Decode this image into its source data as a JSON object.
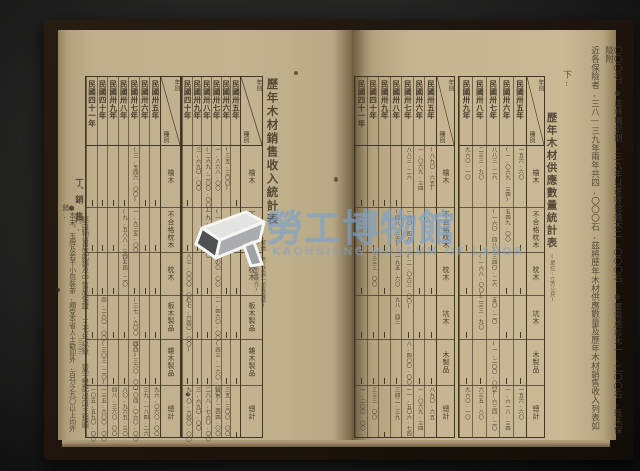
{
  "watermark": {
    "cjk": "勞工博物館",
    "latin": "KAOHSIUNG MUSEUM OF LABOR",
    "accent_color": "#7aa3cd"
  },
  "paper_color": "#c4b390",
  "ink_color": "#453b2c",
  "left_page": {
    "folio": "三三三",
    "section_heading": "丁、銷　售",
    "margin_lines": [
      "經由物資局配銷及中信局保證,三七年以後,豐宇懋記出口主銷順利,",
      "●本末、玉牌及若干小包裝茶,頗受本省人士歡迎外,百分之九〇以上均外銷,"
    ],
    "table": {
      "title": "歷年木材銷售收入統計表",
      "note_lines": [
        "(幣值:卅五至卅七年舊臺幣)",
        "(卅八年以後新臺幣元)"
      ],
      "corner": {
        "top": "年別",
        "bottom": "種別"
      },
      "blocks": [
        {
          "years": [
            "民國卅五年",
            "民國卅六年",
            "民國卅七年",
            "民國卅八年",
            "民國卅九年",
            "民國四十年"
          ],
          "rows": [
            {
              "label": "檜木",
              "cells": [
                "—",
                "(三五,三〇〇)",
                "一,八六八.〇〇",
                "(二六九,二〇〇.〇〇)",
                "三,六九〇.〇〇",
                "—"
              ]
            },
            {
              "label": "不合格枕木",
              "cells": [
                "—",
                "—",
                "(一,九五六.〇〇)",
                "一九,五六〇.〇〇",
                "—",
                "—"
              ]
            },
            {
              "label": "枕木",
              "cells": [
                "—",
                "—",
                "八〇〇.〇〇",
                "—",
                "—",
                "八三,〇〇〇.〇〇"
              ]
            },
            {
              "label": "板木製品",
              "cells": [
                "—",
                "—",
                "二,四六〇.〇〇",
                "—",
                "—",
                "(七,六四〇.〇〇)"
              ]
            },
            {
              "label": "雜木製品",
              "cells": [
                "—",
                "—",
                "(四三,一六〇.〇〇)",
                "—",
                "—",
                "—"
              ]
            },
            {
              "label": "總計",
              "cells": [
                "—",
                "三五,三〇〇.〇〇",
                "四九,二四四.〇〇",
                "二八八,七六〇.〇〇",
                "三,六九〇.〇〇",
                "九�〇,六四〇.〇〇"
              ]
            }
          ]
        },
        {
          "years": [
            "民國卅五年",
            "民國卅六年",
            "民國卅七年",
            "民國卅八年",
            "民國卅九年",
            "民國四十年",
            "民國四十一年"
          ],
          "rows": [
            {
              "label": "檜木",
              "cells": [
                "—",
                "—",
                "(三,五四六.〇〇)",
                "—",
                "—",
                "—",
                "—"
              ]
            },
            {
              "label": "不合格枕木",
              "cells": [
                "—",
                "—",
                "一,九三五.〇〇",
                "(九,五八八.三〇)",
                "—",
                "—",
                "—"
              ]
            },
            {
              "label": "枕木",
              "cells": [
                "—",
                "—",
                "—",
                "六三四.二〇",
                "—",
                "—",
                "—"
              ]
            },
            {
              "label": "板木製品",
              "cells": [
                "—",
                "—",
                "(三七,六〇〇.〇〇)",
                "—",
                "—",
                "四,二六〇.〇〇",
                "—"
              ]
            },
            {
              "label": "雜木製品",
              "cells": [
                "—",
                "—",
                "四八,三六〇.〇〇",
                "—",
                "—",
                "(三〇三.二〇)",
                "—"
              ]
            },
            {
              "label": "總計",
              "cells": [
                "九六,〇六〇.〇〇",
                "三九,一八四.二六",
                "一〇四,〇六〇.〇〇",
                "八〇,九六五.三〇",
                "四八,三六〇.〇〇",
                "一三五,六〇〇.〇〇",
                "一〇五,五九〇.〇〇"
              ]
            }
          ]
        }
      ]
    }
  },
  "right_page": {
    "paragraph_lines": [
      "〇〇〇石。⊕這林場淤期,三九年以遂收拾雜木二,〇〇〇石,⊕軍需處杉木一,二〇〇石,既未保險附",
      "近各保險者,三八—三九年兩年共四,〇〇〇石,茲將歷年木材供應數量及歷年木材銷售收入列表如",
      "下:"
    ],
    "table": {
      "title": "歷年木材供應數量統計表",
      "note_lines": [
        "(單位:立方公尺)"
      ],
      "corner": {
        "top": "年別",
        "bottom": "種別"
      },
      "blocks": [
        {
          "years": [
            "民國卅五年",
            "民國卅六年",
            "民國卅七年",
            "民國卅八年",
            "民國卅九年"
          ],
          "rows": [
            {
              "label": "檜木",
              "cells": [
                "一五六.六〇",
                "(一,〇六九.三四)",
                "八八三.二六",
                "二三三.九〇",
                "九六〇.一〇"
              ]
            },
            {
              "label": "不合格枕木",
              "cells": [
                "—",
                "五四九.〇〇",
                "(一六〇.四八)",
                "—",
                "—"
              ]
            },
            {
              "label": "枕木",
              "cells": [
                "—",
                "—",
                "三四〇.二六",
                "(一六八.〇〇)",
                "—"
              ]
            },
            {
              "label": "坑木",
              "cells": [
                "—",
                "—",
                "五〇.二〇",
                "二三三.九〇",
                "—"
              ]
            },
            {
              "label": "木製品",
              "cells": [
                "—",
                "—",
                "(一,二〇〇.〇〇)",
                "—",
                "—"
              ]
            },
            {
              "label": "總計",
              "cells": [
                "一五六.六〇",
                "一,六一八.三四",
                "二,六三四.二〇",
                "六三五.八〇",
                "九六〇.一〇"
              ]
            }
          ]
        },
        {
          "years": [
            "民國卅五年",
            "民國卅六年",
            "民國卅七年",
            "民國卅八年",
            "民國卅九年",
            "民國四十年",
            "民國四十一年"
          ],
          "rows": [
            {
              "label": "檜木",
              "cells": [
                "(八九〇.六五)",
                "一,〇六九.三四",
                "八八三.二六",
                "—",
                "—",
                "—",
                "—"
              ]
            },
            {
              "label": "不合格枕木",
              "cells": [
                "—",
                "—",
                "一六〇.四八",
                "(四八.三六)",
                "—",
                "—",
                "—"
              ]
            },
            {
              "label": "枕木",
              "cells": [
                "—",
                "—",
                "(二,〇六三.〇〇)",
                "一九五.六〇",
                "—",
                "三三三.〇〇",
                "—"
              ]
            },
            {
              "label": "坑木",
              "cells": [
                "—",
                "—",
                "—",
                "九八.四三",
                "—",
                "—",
                "—"
              ]
            },
            {
              "label": "木製品",
              "cells": [
                "—",
                "—",
                "八,四〇〇.〇〇",
                "—",
                "—",
                "—",
                "—"
              ]
            },
            {
              "label": "總計",
              "cells": [
                "八九〇.六五",
                "一,〇六九.三四",
                "一一,五〇六.七四",
                "三四二.三九",
                "—",
                "三三三.〇〇",
                "一,二〇〇.〇〇"
              ]
            }
          ]
        }
      ]
    }
  }
}
